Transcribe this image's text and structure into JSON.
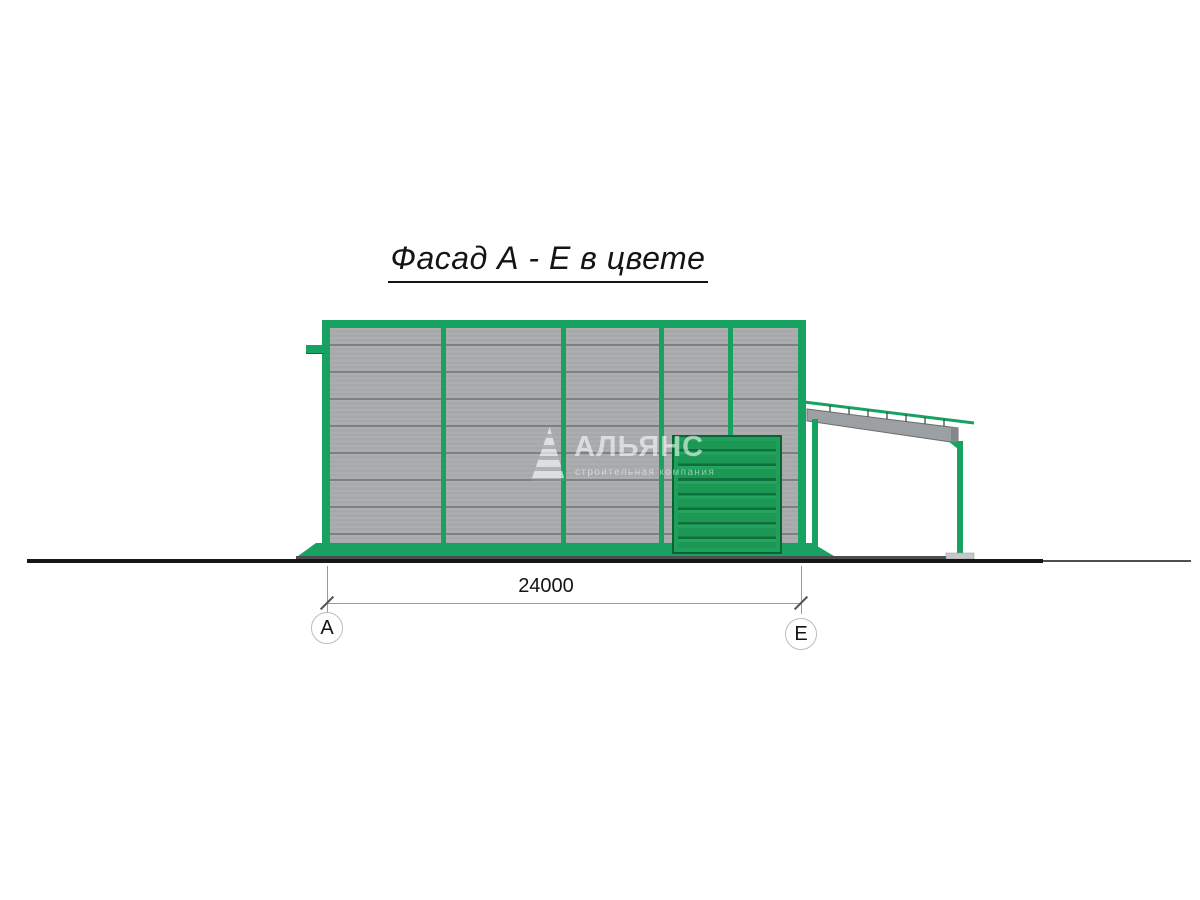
{
  "title": {
    "text": "Фасад А - Е в цвете"
  },
  "dimension": {
    "value": "24000"
  },
  "axis_markers": {
    "left": "А",
    "right": "Е"
  },
  "watermark": {
    "name": "АЛЬЯНС",
    "tagline": "строительная компания"
  },
  "building": {
    "bays": 5,
    "door_panels": 8
  },
  "colors": {
    "frame_green": "#18a261",
    "door_green": "#1f9e58",
    "door_joint": "#0e6e3e",
    "siding_gray": "#a8aaac",
    "siding_joint": "#7e8083",
    "beam_gray": "#9ca0a2",
    "ground_black": "#161616"
  }
}
